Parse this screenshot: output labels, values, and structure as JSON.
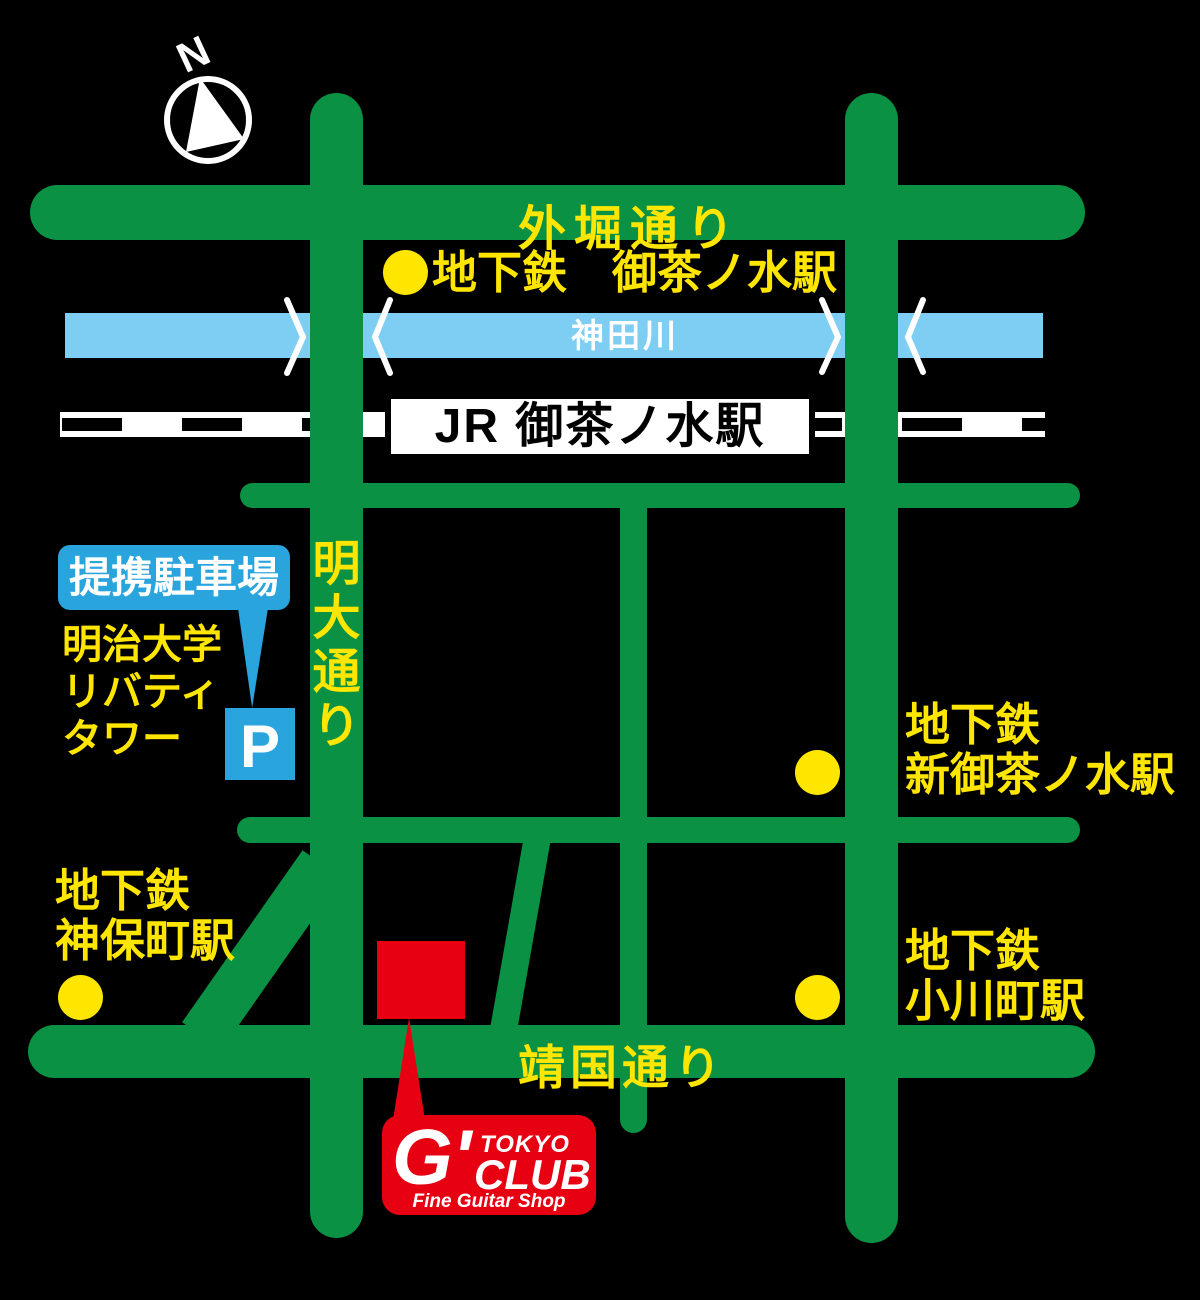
{
  "compass": {
    "north_label": "N"
  },
  "roads": {
    "sotobori": {
      "label": "外堀通り"
    },
    "yasukuni": {
      "label": "靖国通り"
    },
    "meidai": {
      "label": "明大通り",
      "chars": [
        "明",
        "大",
        "通",
        "り"
      ]
    }
  },
  "river": {
    "label": "神田川"
  },
  "jr_station": {
    "label": "JR 御茶ノ水駅"
  },
  "stations": {
    "metro_ochanomizu": {
      "label": "地下鉄　御茶ノ水駅"
    },
    "shin_ochanomizu": {
      "line1": "地下鉄",
      "line2": "新御茶ノ水駅"
    },
    "jimbocho": {
      "line1": "地下鉄",
      "line2": "神保町駅"
    },
    "ogawamachi": {
      "line1": "地下鉄",
      "line2": "小川町駅"
    }
  },
  "parking": {
    "bubble_label": "提携駐車場",
    "building_line1": "明治大学",
    "building_line2": "リバティ",
    "building_line3": "タワー",
    "p_label": "P"
  },
  "logo": {
    "g": "G'",
    "tokyo": "TOKYO",
    "club": "CLUB",
    "tagline": "Fine Guitar Shop"
  },
  "colors": {
    "green": "#0a9143",
    "yellow": "#ffe600",
    "river": "#7ecef4",
    "blue": "#29a4dd",
    "red": "#e60012",
    "black": "#000000"
  }
}
